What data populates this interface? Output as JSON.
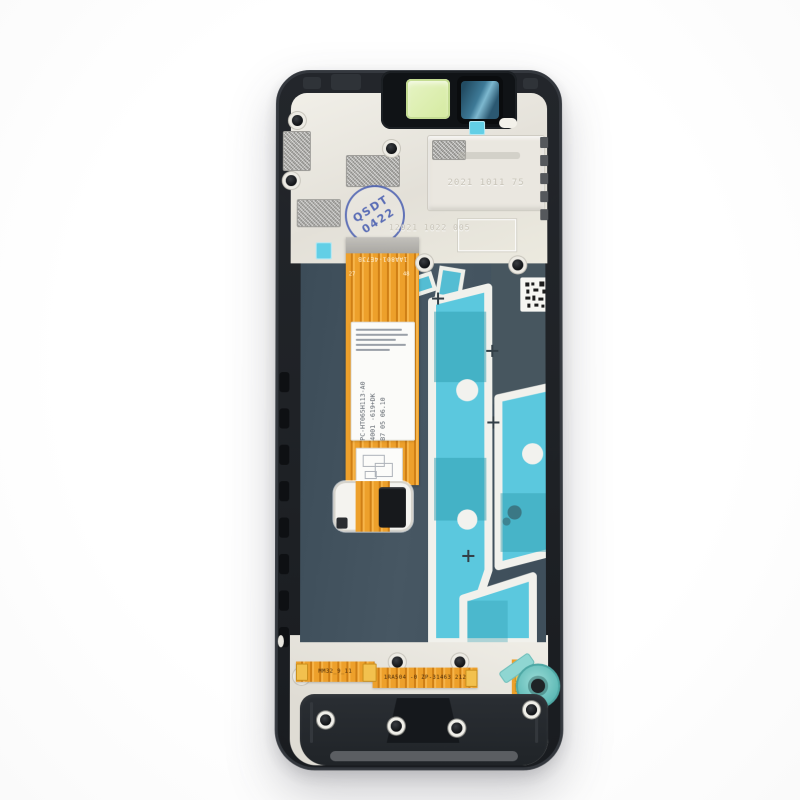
{
  "scene": {
    "description": "Smartphone LCD display assembly with frame, rear view, product photo on white background"
  },
  "stamp": {
    "top": "QSDT",
    "bottom": "0422"
  },
  "molded": {
    "date_code": "2021 1011 75",
    "batch_code": "12021 1022 005"
  },
  "main_flex": {
    "top_code": "1AA801-4E73B",
    "pin_left": "27",
    "pin_right": "48",
    "label_line1": "FPC-HT065H113-A0",
    "label_line2": "A4001 -619+DK",
    "label_line3": "RB7 05 06.10"
  },
  "bottom_flex": {
    "code_left": "MM32_9_11",
    "code_right": "1RA504 -0 ZP-31463 212"
  },
  "colors": {
    "frame_black": "#202428",
    "back_plastic_cream": "#ece9e1",
    "panel_slate": "#43535f",
    "tape_cyan": "#5bc8de",
    "tape_teal": "#2e9cae",
    "flex_orange": "#e8961f",
    "stamp_blue": "#4f62b1",
    "camera_film_teal": "#3e7a97",
    "mint_sticker": "#dcefae",
    "service_ring_teal": "#7fd0cb",
    "connector_tab_blue": "#4553d6"
  }
}
